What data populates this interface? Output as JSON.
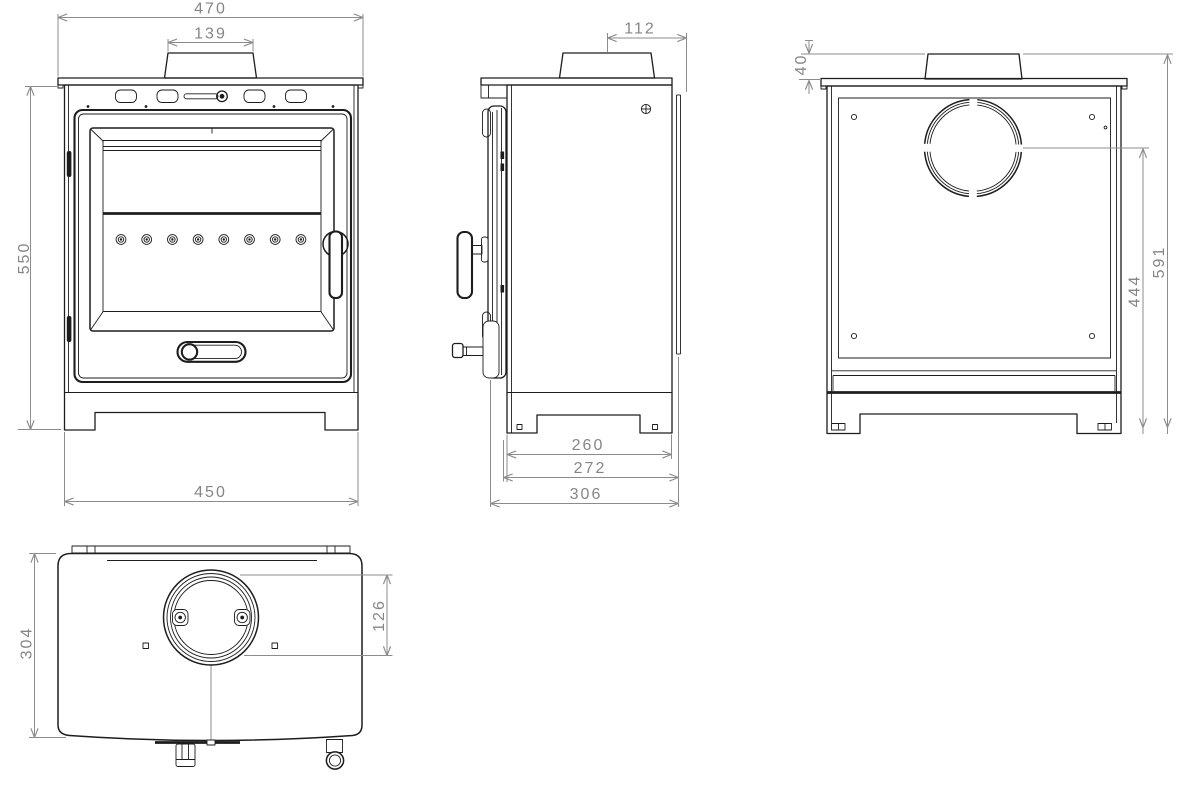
{
  "colors": {
    "background": "#ffffff",
    "object_line": "#1d1d1d",
    "dimension_line": "#8c8c8c",
    "dimension_text": "#868686"
  },
  "views": {
    "front": {
      "dims": {
        "top_plate_width": "470",
        "flue_collar_width": "139",
        "height": "550",
        "base_width": "450"
      }
    },
    "side": {
      "dims": {
        "flue_center_to_back": "112",
        "body_depth": "260",
        "depth_with_door": "272",
        "overall_depth": "306"
      }
    },
    "back": {
      "dims": {
        "collar_height": "40",
        "flue_center_height": "444",
        "overall_height": "591"
      }
    },
    "top": {
      "dims": {
        "depth": "304",
        "flue_opening": "126"
      }
    }
  }
}
